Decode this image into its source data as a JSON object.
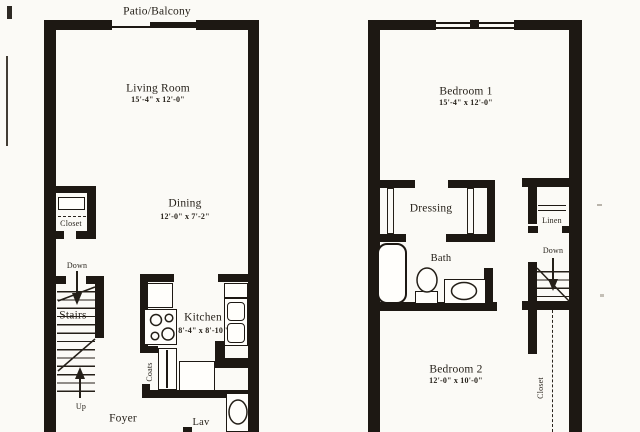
{
  "colors": {
    "wall": "#1d1813",
    "paper": "#fbfaf6",
    "ink": "#241f18"
  },
  "first_floor": {
    "patio_label": "Patio/Balcony",
    "living_room": {
      "name": "Living Room",
      "dims": "15'-4\" x 12'-0\""
    },
    "dining": {
      "name": "Dining",
      "dims": "12'-0\" x 7'-2\""
    },
    "closet_label": "Closet",
    "stairs": {
      "down_label": "Down",
      "label": "Stairs",
      "up_label": "Up"
    },
    "kitchen": {
      "name": "Kitchen",
      "dims": "8'-4\" x 8'-10\""
    },
    "coats_label": "Coats",
    "foyer_label": "Foyer",
    "lav_label": "Lav"
  },
  "second_floor": {
    "bedroom1": {
      "name": "Bedroom 1",
      "dims": "15'-4\" x 12'-0\""
    },
    "dressing_label": "Dressing",
    "bath_label": "Bath",
    "linen_label": "Linen",
    "stairs_down_label": "Down",
    "bedroom2": {
      "name": "Bedroom 2",
      "dims": "12'-0\" x 10'-0\""
    },
    "closet_label": "Closet"
  }
}
